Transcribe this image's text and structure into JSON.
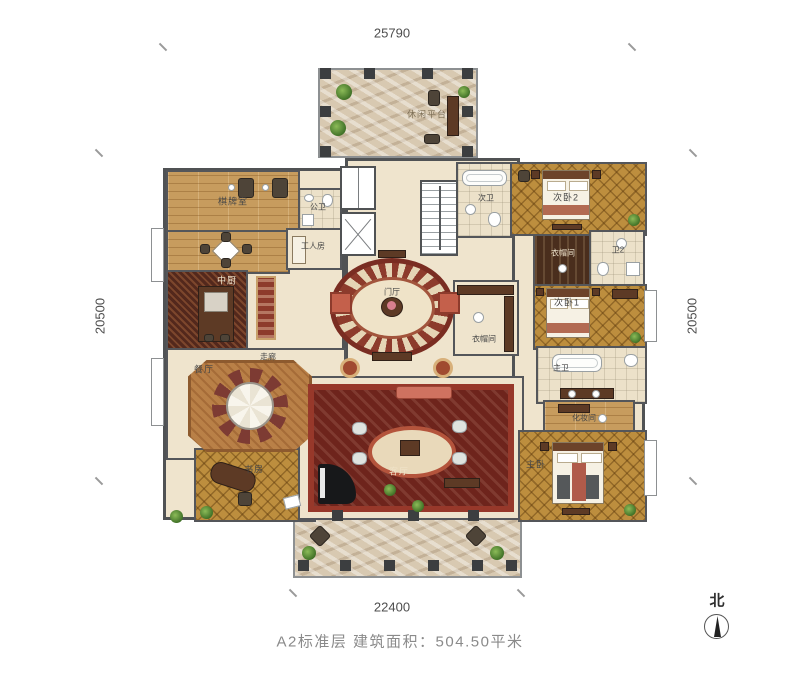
{
  "caption": "A2标准层 建筑面积：504.50平米",
  "dimensions": {
    "top": "25790",
    "bottom": "22400",
    "left": "20500",
    "right": "20500"
  },
  "compass": {
    "label": "北"
  },
  "rooms": {
    "terrace_top": {
      "label": "休闲平台"
    },
    "game_room": {
      "label": "棋牌室"
    },
    "public_bath": {
      "label": "公卫"
    },
    "staff_room": {
      "label": "工人房"
    },
    "kitchen": {
      "label": "中厨"
    },
    "dining": {
      "label": "餐厅"
    },
    "corridor": {
      "label": "走廊"
    },
    "study": {
      "label": "书房"
    },
    "foyer": {
      "label": "门厅"
    },
    "cloak_center": {
      "label": "衣帽间"
    },
    "living": {
      "label": "客厅"
    },
    "guest_bath": {
      "label": "次卫"
    },
    "bedroom2": {
      "label": "次卧2"
    },
    "cloak2": {
      "label": "衣帽间"
    },
    "bath2": {
      "label": "卫2"
    },
    "bedroom1": {
      "label": "次卧1"
    },
    "master_bath": {
      "label": "主卫"
    },
    "dressing": {
      "label": "化妆间"
    },
    "master_bedroom": {
      "label": "主卧"
    }
  }
}
